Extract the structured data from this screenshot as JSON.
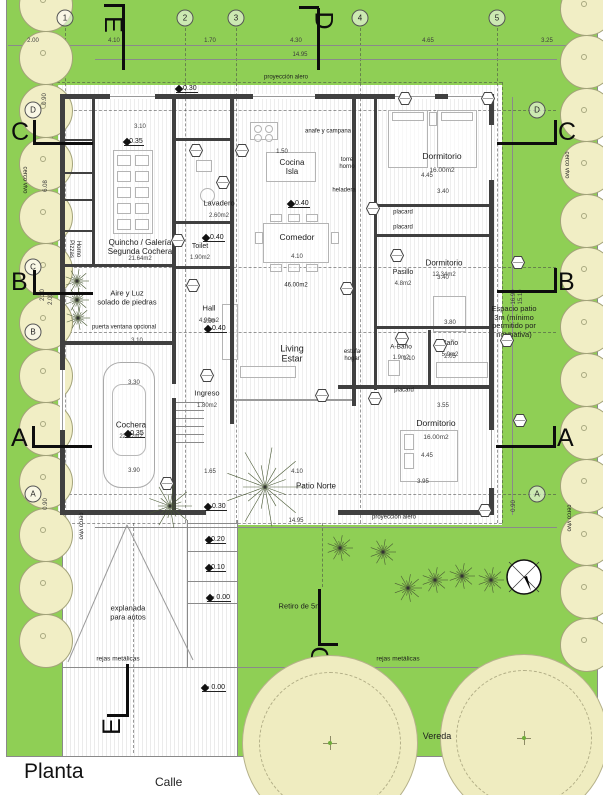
{
  "plan": {
    "title": "Planta",
    "street": "Calle",
    "sidewalk": "Vereda"
  },
  "colors": {
    "grass": "#8fcf55",
    "hedge": "#f1eec5",
    "tree": "#efecc0",
    "wall": "#404040",
    "ink": "#1c1c1c"
  },
  "grid": {
    "top": [
      {
        "label": "1",
        "x": 65
      },
      {
        "label": "2",
        "x": 185
      },
      {
        "label": "3",
        "x": 236
      },
      {
        "label": "4",
        "x": 360
      },
      {
        "label": "5",
        "x": 497
      }
    ],
    "left": [
      {
        "label": "D",
        "x": 33,
        "y": 110
      },
      {
        "label": "C",
        "x": 33,
        "y": 267
      },
      {
        "label": "B",
        "x": 33,
        "y": 332
      },
      {
        "label": "A",
        "x": 33,
        "y": 494
      }
    ],
    "right": [
      {
        "label": "D",
        "x": 537,
        "y": 110
      },
      {
        "label": "A",
        "x": 537,
        "y": 494
      }
    ]
  },
  "section_markers": [
    {
      "label": "E",
      "tx": 104,
      "ty": 10,
      "rot": 90,
      "lines": [
        [
          122,
          6,
          3,
          64
        ],
        [
          104,
          4,
          21,
          3
        ]
      ]
    },
    {
      "label": "D",
      "tx": 314,
      "ty": 6,
      "rot": 90,
      "lines": [
        [
          317,
          8,
          3,
          62
        ],
        [
          299,
          6,
          20,
          3
        ]
      ]
    },
    {
      "label": "C",
      "tx": 11,
      "ty": 118,
      "rot": 0,
      "lines": [
        [
          33,
          120,
          3,
          25
        ],
        [
          33,
          142,
          60,
          3
        ]
      ]
    },
    {
      "label": "B",
      "tx": 11,
      "ty": 268,
      "rot": 0,
      "lines": [
        [
          33,
          270,
          3,
          25
        ],
        [
          33,
          292,
          60,
          3
        ]
      ]
    },
    {
      "label": "A",
      "tx": 11,
      "ty": 424,
      "rot": 0,
      "lines": [
        [
          32,
          426,
          3,
          22
        ],
        [
          32,
          445,
          60,
          3
        ]
      ]
    },
    {
      "label": "C",
      "tx": 558,
      "ty": 118,
      "rot": 0,
      "lines": [
        [
          554,
          120,
          3,
          25
        ],
        [
          497,
          142,
          60,
          3
        ]
      ]
    },
    {
      "label": "B",
      "tx": 558,
      "ty": 268,
      "rot": 0,
      "lines": [
        [
          554,
          268,
          3,
          25
        ],
        [
          497,
          290,
          60,
          3
        ]
      ]
    },
    {
      "label": "A",
      "tx": 557,
      "ty": 424,
      "rot": 0,
      "lines": [
        [
          553,
          426,
          3,
          22
        ],
        [
          496,
          445,
          60,
          3
        ]
      ]
    },
    {
      "label": "D",
      "tx": 312,
      "ty": 641,
      "rot": -90,
      "lines": [
        [
          318,
          589,
          3,
          55
        ],
        [
          318,
          643,
          20,
          3
        ]
      ]
    },
    {
      "label": "E",
      "tx": 104,
      "ty": 712,
      "rot": -90,
      "lines": [
        [
          126,
          664,
          3,
          50
        ],
        [
          107,
          714,
          22,
          3
        ]
      ]
    }
  ],
  "rooms": [
    {
      "name": "Quincho / Galería\nSegunda Cochera",
      "area": "21.64m2",
      "x": 140,
      "y": 247,
      "size": 8
    },
    {
      "name": "Lavadero",
      "area": "2.60m2",
      "x": 219,
      "y": 204,
      "size": 7.5
    },
    {
      "name": "Toilet",
      "area": "1.90m2",
      "x": 200,
      "y": 247,
      "size": 7
    },
    {
      "name": "Cocina\nIsla",
      "x": 292,
      "y": 167,
      "size": 8
    },
    {
      "name": "Comedor",
      "x": 297,
      "y": 238,
      "size": 8.5
    },
    {
      "name": "Dormitorio",
      "area": "16.00m2",
      "x": 442,
      "y": 157,
      "size": 8.5
    },
    {
      "name": "Pasillo",
      "area": "4.8m2",
      "x": 403,
      "y": 273,
      "size": 7
    },
    {
      "name": "Dormitorio",
      "area": "12.34m2",
      "x": 444,
      "y": 263,
      "size": 8
    },
    {
      "name": "A-Baño",
      "area": "1.9m2",
      "x": 401,
      "y": 347,
      "size": 6.5
    },
    {
      "name": "Baño",
      "area": "5.9m2",
      "x": 450,
      "y": 344,
      "size": 7
    },
    {
      "name": "Dormitorio",
      "area": "16.00m2",
      "x": 436,
      "y": 424,
      "size": 8.5
    },
    {
      "name": "Hall",
      "area": "4.90m2",
      "x": 209,
      "y": 309,
      "size": 7.5
    },
    {
      "name": "Living\nEstar",
      "x": 292,
      "y": 354,
      "size": 9
    },
    {
      "name": "Ingreso",
      "area": "1.80m2",
      "x": 207,
      "y": 394,
      "size": 7.5
    },
    {
      "name": "Cochera",
      "area": "22.42m2",
      "x": 131,
      "y": 425,
      "size": 8
    },
    {
      "name": "Patio Norte",
      "x": 316,
      "y": 486,
      "size": 8
    },
    {
      "name": "placard",
      "x": 403,
      "y": 213,
      "size": 6
    },
    {
      "name": "placard",
      "x": 403,
      "y": 228,
      "size": 6
    },
    {
      "name": "placard",
      "x": 404,
      "y": 391,
      "size": 6
    },
    {
      "name": "Aire y Luz\nsolado de piedras",
      "x": 127,
      "y": 298,
      "size": 7.5
    },
    {
      "name": "Espacio patio\n3m (mínimo\npermitido por\nnormativa)",
      "x": 514,
      "y": 322,
      "size": 7.5
    },
    {
      "name": "explanada\npara autos",
      "x": 128,
      "y": 613,
      "size": 7.5
    }
  ],
  "annotations": [
    {
      "text": "anafe y  campana",
      "x": 328,
      "y": 132,
      "size": 6
    },
    {
      "text": "torre\nhorno",
      "x": 347,
      "y": 164,
      "size": 6
    },
    {
      "text": "heladera",
      "x": 344,
      "y": 191,
      "size": 6
    },
    {
      "text": "estufa\nhogar",
      "x": 352,
      "y": 356,
      "size": 6
    },
    {
      "text": "46.00m2",
      "x": 296,
      "y": 286,
      "size": 6
    },
    {
      "text": "puerta ventana opcional",
      "x": 124,
      "y": 328,
      "size": 6
    },
    {
      "text": "proyección alero",
      "x": 286,
      "y": 78,
      "size": 6
    },
    {
      "text": "proyección alero",
      "x": 394,
      "y": 518,
      "size": 6
    },
    {
      "text": "rejas metálicas",
      "x": 118,
      "y": 659,
      "size": 6.5
    },
    {
      "text": "rejas metálicas",
      "x": 398,
      "y": 659,
      "size": 6.5
    },
    {
      "text": "Retiro de 5m",
      "x": 300,
      "y": 607,
      "size": 7.5
    },
    {
      "text": "Horno\nPizzas",
      "x": 74,
      "y": 249,
      "size": 6,
      "rot": 90
    },
    {
      "text": "cerco vivo",
      "x": 24,
      "y": 180,
      "size": 6,
      "rot": 90
    },
    {
      "text": "cerco vivo",
      "x": 80,
      "y": 526,
      "size": 6,
      "rot": 90
    },
    {
      "text": "cerco vivo",
      "x": 566,
      "y": 165,
      "size": 6,
      "rot": 90
    },
    {
      "text": "cerco vivo",
      "x": 568,
      "y": 518,
      "size": 6,
      "rot": 90
    }
  ],
  "levels": [
    {
      "text": "+ 0.30",
      "x": 176,
      "y": 89
    },
    {
      "text": "+0.35",
      "x": 124,
      "y": 142
    },
    {
      "text": "+ 0.40",
      "x": 288,
      "y": 204
    },
    {
      "text": "+ 0.40",
      "x": 203,
      "y": 238
    },
    {
      "text": "+ 0.40",
      "x": 205,
      "y": 329
    },
    {
      "text": "+0.35",
      "x": 125,
      "y": 434
    },
    {
      "text": "+ 0.30",
      "x": 205,
      "y": 507
    },
    {
      "text": "+0.20",
      "x": 206,
      "y": 540
    },
    {
      "text": "+0.10",
      "x": 206,
      "y": 568
    },
    {
      "text": "+- 0.00",
      "x": 207,
      "y": 598
    },
    {
      "text": "+- 0.00",
      "x": 202,
      "y": 688
    }
  ],
  "dimensions": {
    "top": [
      {
        "t": "2.00",
        "x": 33,
        "y": 41
      },
      {
        "t": "4.10",
        "x": 114,
        "y": 41
      },
      {
        "t": "1.70",
        "x": 210,
        "y": 41
      },
      {
        "t": "4.30",
        "x": 296,
        "y": 41
      },
      {
        "t": "4.65",
        "x": 428,
        "y": 41
      },
      {
        "t": "3.25",
        "x": 547,
        "y": 41
      },
      {
        "t": "14.95",
        "x": 300,
        "y": 55
      }
    ],
    "bottom": [
      {
        "t": "14.95",
        "x": 296,
        "y": 521
      }
    ],
    "left": [
      {
        "t": "0.90",
        "x": 45,
        "y": 99
      },
      {
        "t": "6.08",
        "x": 46,
        "y": 186
      },
      {
        "t": "2.20",
        "x": 43,
        "y": 295
      },
      {
        "t": "2.00",
        "x": 51,
        "y": 299
      },
      {
        "t": "0.90",
        "x": 46,
        "y": 504
      }
    ],
    "right": [
      {
        "t": "16.90",
        "x": 514,
        "y": 297
      },
      {
        "t": "15.10",
        "x": 521,
        "y": 297
      },
      {
        "t": "0.90",
        "x": 514,
        "y": 506
      }
    ],
    "inner": [
      {
        "t": "3.10",
        "x": 140,
        "y": 127
      },
      {
        "t": "1.50",
        "x": 282,
        "y": 152
      },
      {
        "t": "4.10",
        "x": 297,
        "y": 257
      },
      {
        "t": "1.50",
        "x": 209,
        "y": 322
      },
      {
        "t": "4.45",
        "x": 427,
        "y": 176
      },
      {
        "t": "3.40",
        "x": 443,
        "y": 192
      },
      {
        "t": "3.40",
        "x": 443,
        "y": 278
      },
      {
        "t": "3.80",
        "x": 450,
        "y": 323
      },
      {
        "t": "1.10",
        "x": 409,
        "y": 359
      },
      {
        "t": "2.05",
        "x": 450,
        "y": 357
      },
      {
        "t": "3.55",
        "x": 443,
        "y": 406
      },
      {
        "t": "4.45",
        "x": 427,
        "y": 456
      },
      {
        "t": "3.95",
        "x": 423,
        "y": 482
      },
      {
        "t": "1.65",
        "x": 210,
        "y": 472
      },
      {
        "t": "4.10",
        "x": 297,
        "y": 472
      },
      {
        "t": "3.10",
        "x": 137,
        "y": 341
      },
      {
        "t": "3.30",
        "x": 134,
        "y": 383
      },
      {
        "t": "3.90",
        "x": 134,
        "y": 471
      }
    ]
  },
  "tags": [
    {
      "x": 196,
      "y": 150
    },
    {
      "x": 242,
      "y": 150
    },
    {
      "x": 178,
      "y": 240
    },
    {
      "x": 223,
      "y": 182
    },
    {
      "x": 373,
      "y": 208
    },
    {
      "x": 397,
      "y": 255
    },
    {
      "x": 405,
      "y": 98
    },
    {
      "x": 488,
      "y": 98
    },
    {
      "x": 518,
      "y": 262
    },
    {
      "x": 507,
      "y": 340
    },
    {
      "x": 402,
      "y": 338
    },
    {
      "x": 440,
      "y": 345
    },
    {
      "x": 375,
      "y": 398
    },
    {
      "x": 520,
      "y": 420
    },
    {
      "x": 485,
      "y": 510
    },
    {
      "x": 193,
      "y": 285
    },
    {
      "x": 347,
      "y": 288
    },
    {
      "x": 207,
      "y": 375
    },
    {
      "x": 322,
      "y": 395
    },
    {
      "x": 167,
      "y": 483
    }
  ],
  "compass": {
    "x": 524,
    "y": 577,
    "r": 18
  },
  "trees": [
    {
      "x": 330,
      "y": 743,
      "r": 88
    },
    {
      "x": 524,
      "y": 738,
      "r": 84
    }
  ],
  "shrubs": [
    {
      "x": 265,
      "y": 487,
      "r": 40
    },
    {
      "x": 170,
      "y": 506,
      "r": 22
    },
    {
      "x": 77,
      "y": 281,
      "r": 12
    },
    {
      "x": 77,
      "y": 300,
      "r": 12
    },
    {
      "x": 78,
      "y": 318,
      "r": 12
    },
    {
      "x": 340,
      "y": 548,
      "r": 13
    },
    {
      "x": 383,
      "y": 552,
      "r": 13
    },
    {
      "x": 408,
      "y": 588,
      "r": 14
    },
    {
      "x": 435,
      "y": 580,
      "r": 13
    },
    {
      "x": 462,
      "y": 576,
      "r": 13
    },
    {
      "x": 491,
      "y": 580,
      "r": 13
    }
  ]
}
